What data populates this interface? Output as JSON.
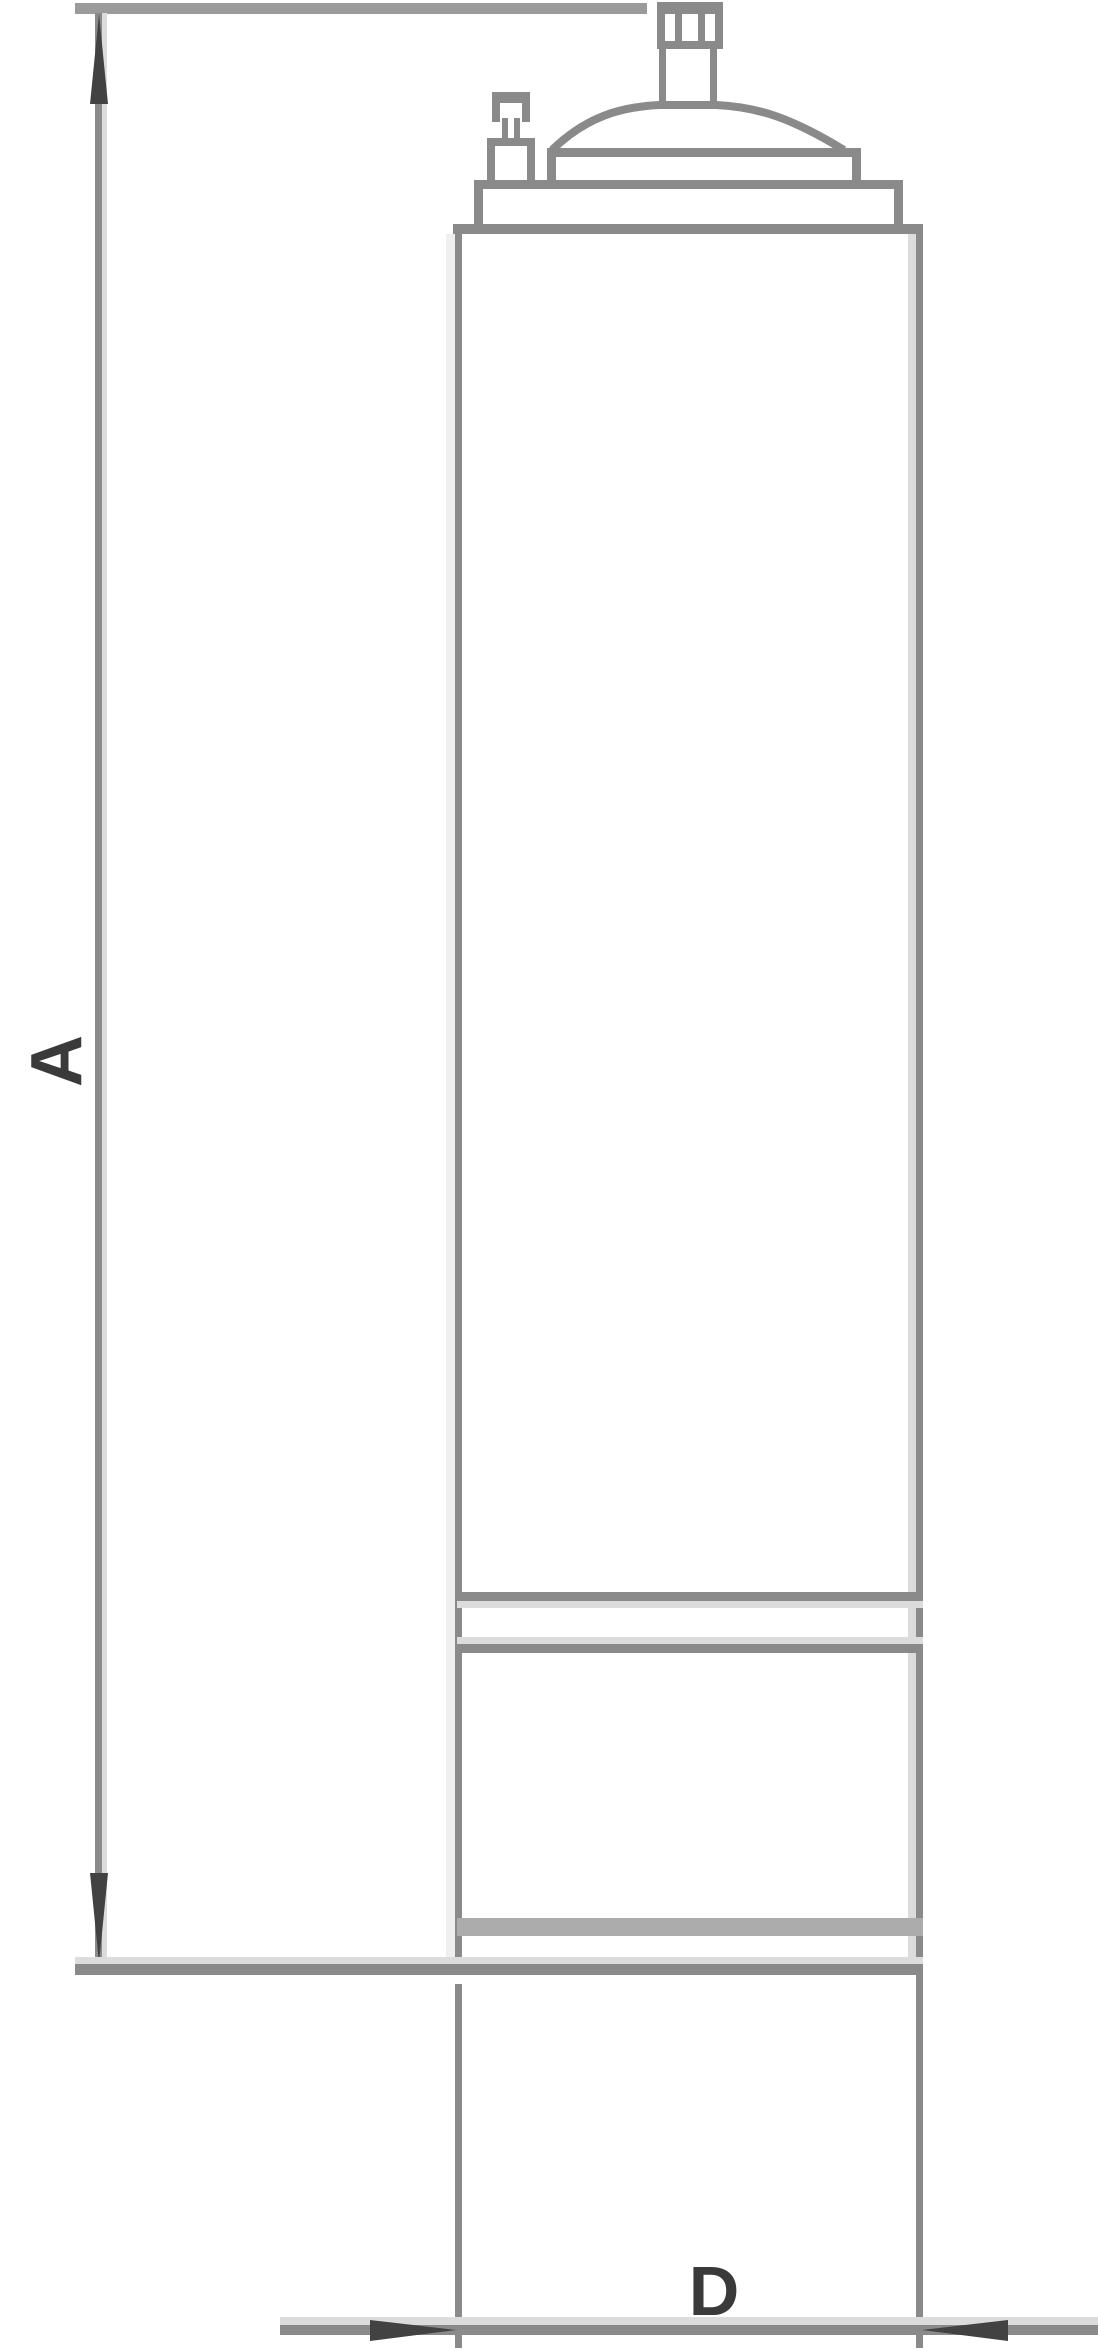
{
  "diagram": {
    "kind": "technical-outline-drawing",
    "dimensions": [
      {
        "label": "A",
        "axis": "vertical"
      },
      {
        "label": "D",
        "axis": "horizontal"
      }
    ],
    "colors": {
      "line": "#8a8a8a",
      "line_mid": "#9b9b9b",
      "line_light": "#dcdcdc",
      "line_faint": "#efefef",
      "band": "#acacac",
      "arrow": "#424242",
      "text": "#3a3a3a",
      "bg": "#ffffff"
    }
  }
}
